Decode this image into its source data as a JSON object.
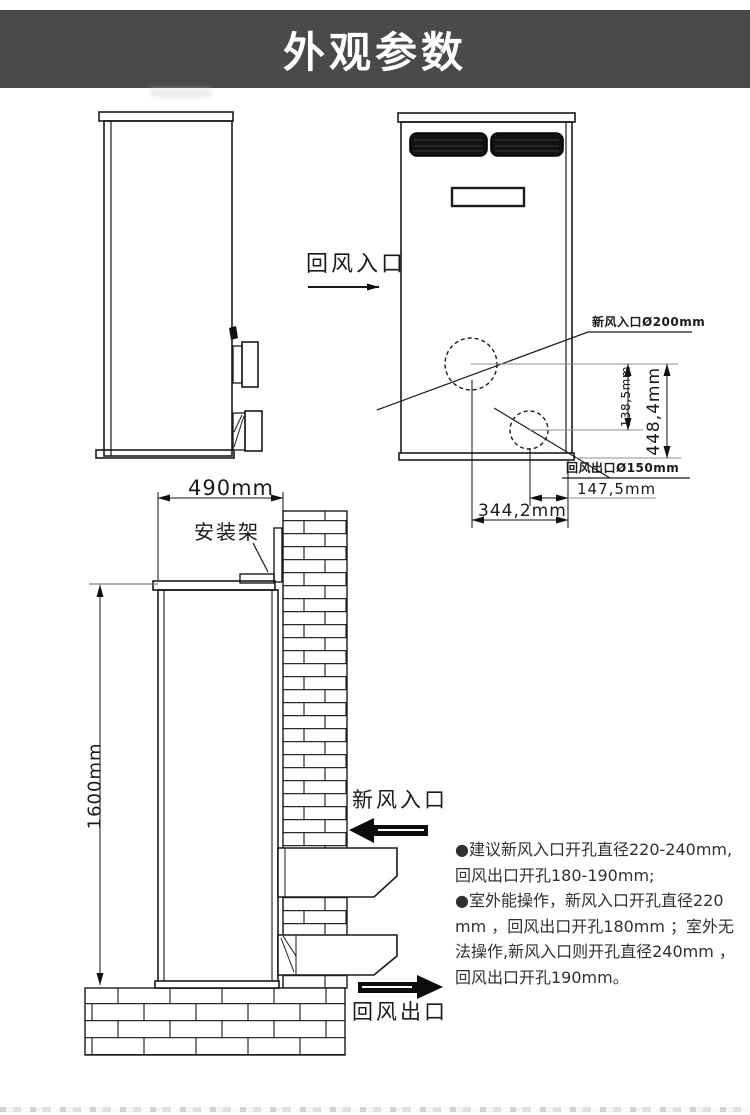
{
  "header": {
    "title": "外观参数"
  },
  "colors": {
    "banner_bg": "#4a4a4a",
    "banner_text": "#ffffff",
    "line": "#1a1a1a",
    "grille": "#121212",
    "note_text": "#303030"
  },
  "side_view": {
    "return_air_inlet_label": "回风入口"
  },
  "front_view": {
    "fresh_air_hole_label": "新风入口Ø200mm",
    "return_air_hole_label": "回风出口Ø150mm",
    "dim_top_to_lower_hole": "138,5mm",
    "dim_top_to_bottom": "448,4mm",
    "dim_hole_to_edge": "147,5mm",
    "dim_hole_to_center": "344,2mm"
  },
  "installation_view": {
    "width_dim": "490mm",
    "height_dim": "1600mm",
    "bracket_label": "安装架",
    "fresh_air_inlet_label": "新风入口",
    "return_air_outlet_label": "回风出口"
  },
  "notes": {
    "lines": [
      "●建议新风入口开孔直径220-240mm,",
      "回风出口开孔180-190mm;",
      "●室外能操作，新风入口开孔直径220",
      "mm ，回风出口开孔180mm ；室外无",
      "法操作,新风入口则开孔直径240mm ，",
      "回风出口开孔190mm。"
    ]
  }
}
